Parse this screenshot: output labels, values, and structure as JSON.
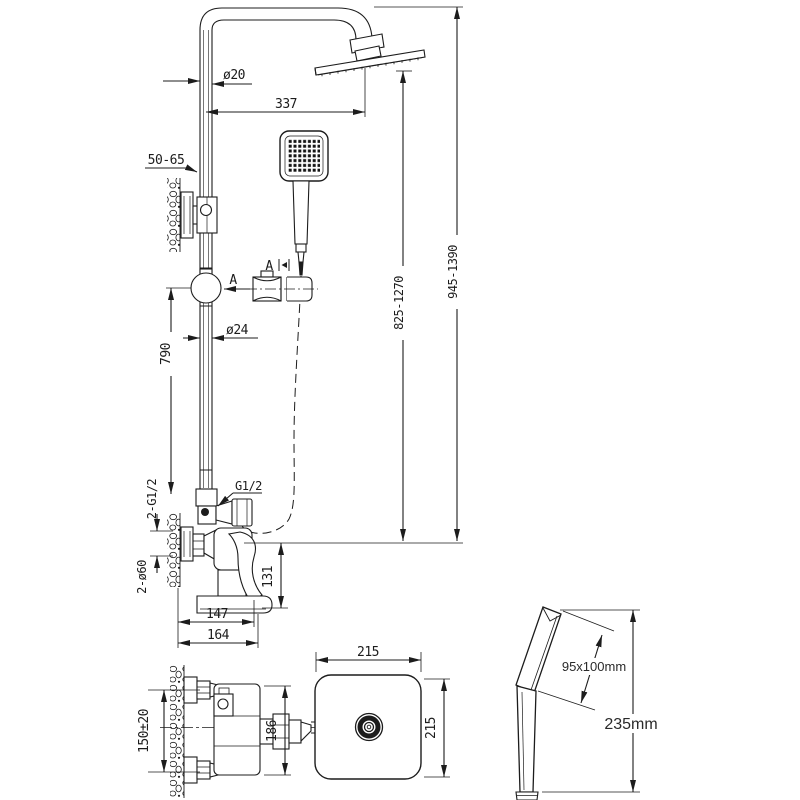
{
  "title": "shower-set-technical-drawing",
  "colors": {
    "line": "#1c1c1c",
    "background": "#ffffff"
  },
  "front_view": {
    "pipe_diameter_top": "ø20",
    "arm_length": "337",
    "wall_offset": "50-65",
    "riser_length": "790",
    "pipe_diameter_mid": "ø24",
    "section_arrow_label": "A",
    "detail_view_label": "A",
    "height_head_range": "945-1390",
    "height_outlet_range": "825-1270",
    "outlet_thread": "G1/2",
    "inlet_threads": "2-G1/2",
    "escutcheons": "2-ø60",
    "spout_drop": "131",
    "body_width": "147",
    "body_width_total": "164"
  },
  "plan_view": {
    "inlet_spacing": "150±20",
    "body_depth": "186",
    "head_width": "215",
    "head_depth": "215"
  },
  "hand_shower_view": {
    "head_size": "95x100mm",
    "total_length": "235mm"
  }
}
